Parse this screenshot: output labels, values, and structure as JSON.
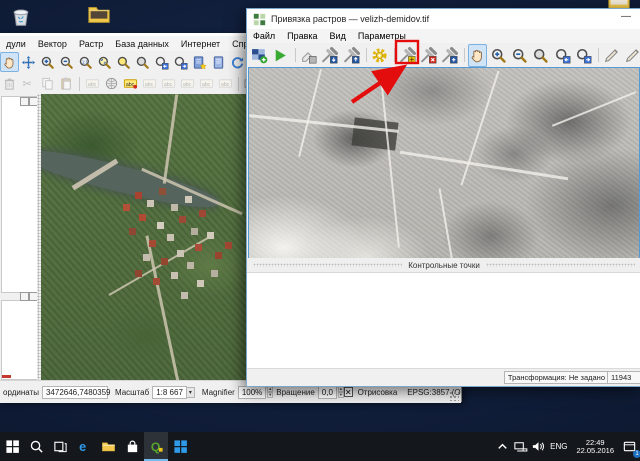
{
  "colors": {
    "annotation_red": "#e40d0d",
    "selection_blue": "#549bd5",
    "desktop_blue": "#0e1a33"
  },
  "desktop": {
    "icons": [
      {
        "id": "recycle-bin"
      },
      {
        "id": "folder-open"
      },
      {
        "id": "folder-top-right"
      }
    ]
  },
  "main_window": {
    "menu": [
      {
        "id": "modules",
        "label": "дули"
      },
      {
        "id": "vector",
        "label": "Вектор"
      },
      {
        "id": "raster",
        "label": "Растр"
      },
      {
        "id": "database",
        "label": "База данных"
      },
      {
        "id": "web",
        "label": "Интернет"
      },
      {
        "id": "help",
        "label": "Справка"
      }
    ],
    "toolbar1": [
      {
        "id": "pan",
        "icon": "hand",
        "pressed": true
      },
      {
        "id": "pan-to-selection",
        "icon": "move"
      },
      {
        "id": "zoom-in",
        "icon": "zoomin"
      },
      {
        "id": "zoom-out",
        "icon": "zoomout"
      },
      {
        "id": "zoom-native",
        "icon": "zoomnative"
      },
      {
        "id": "zoom-full",
        "icon": "zoomfull"
      },
      {
        "id": "zoom-to-selection",
        "icon": "zoomsel"
      },
      {
        "id": "zoom-to-layer",
        "icon": "zoomlayer"
      },
      {
        "id": "zoom-last",
        "icon": "zoomlast"
      },
      {
        "id": "zoom-next",
        "icon": "zoomnext"
      },
      {
        "id": "new-bookmark",
        "icon": "booknew"
      },
      {
        "id": "show-bookmarks",
        "icon": "bookshow"
      },
      {
        "id": "refresh",
        "icon": "refresh"
      }
    ],
    "toolbar2": [
      {
        "id": "delete-selected",
        "icon": "trash",
        "disabled": true
      },
      {
        "id": "cut-features",
        "icon": "cut",
        "disabled": true
      },
      {
        "id": "copy-features",
        "icon": "copy",
        "disabled": true
      },
      {
        "id": "paste-features",
        "icon": "paste",
        "disabled": true
      },
      {
        "sep": true
      },
      {
        "id": "labeling-options",
        "icon": "abc",
        "disabled": true
      },
      {
        "id": "label-pie",
        "icon": "sphere"
      },
      {
        "id": "labeling-active",
        "icon": "abcactive"
      },
      {
        "id": "pin-labels",
        "icon": "abc",
        "disabled": true
      },
      {
        "id": "highlight-labels",
        "icon": "abc",
        "disabled": true
      },
      {
        "id": "move-label",
        "icon": "abc",
        "disabled": true
      },
      {
        "id": "rotate-label",
        "icon": "abc",
        "disabled": true
      },
      {
        "id": "change-label",
        "icon": "abc",
        "disabled": true
      },
      {
        "sep": true
      },
      {
        "id": "csw-search",
        "icon": "csw"
      }
    ],
    "statusbar": {
      "coord_label": "ординаты",
      "coord_value": "3472646,7480359",
      "scale_label": "Масштаб",
      "scale_value": "1:8 667",
      "magnifier_label": "Magnifier",
      "magnifier_value": "100%",
      "rotation_label": "Вращение",
      "rotation_value": "0,0",
      "render_checkbox_glyph": "✕",
      "render_label": "Отрисовка",
      "crs_value": "EPSG:3857 (OTF)"
    }
  },
  "georeferencer": {
    "title": "Привязка растров — velizh-demidov.tif",
    "minimize_glyph": "—",
    "menu": [
      {
        "id": "file",
        "label": "Файл"
      },
      {
        "id": "edit",
        "label": "Правка"
      },
      {
        "id": "view",
        "label": "Вид"
      },
      {
        "id": "settings",
        "label": "Параметры"
      }
    ],
    "toolbar": [
      {
        "id": "open-raster",
        "icon": "checker"
      },
      {
        "id": "start-georeferencing",
        "icon": "play"
      },
      {
        "sep": true
      },
      {
        "id": "gdal-script",
        "icon": "script"
      },
      {
        "id": "load-gcp",
        "icon": "satload"
      },
      {
        "id": "save-gcp",
        "icon": "satsave"
      },
      {
        "sep": true
      },
      {
        "id": "transformation-settings",
        "icon": "gear"
      },
      {
        "sep": true
      },
      {
        "id": "add-point",
        "icon": "satadd",
        "boxed": true
      },
      {
        "id": "delete-point",
        "icon": "satdel"
      },
      {
        "id": "move-point",
        "icon": "satmove"
      },
      {
        "sep": true
      },
      {
        "id": "pan",
        "icon": "hand",
        "pressed": true
      },
      {
        "id": "zoom-in",
        "icon": "zoomin"
      },
      {
        "id": "zoom-out",
        "icon": "zoomout"
      },
      {
        "id": "zoom-to-layer",
        "icon": "zoomlayer"
      },
      {
        "id": "zoom-last",
        "icon": "zoomlast"
      },
      {
        "id": "zoom-next",
        "icon": "zoomnext"
      },
      {
        "sep": true
      },
      {
        "id": "link-georef-to-qgis",
        "icon": "pencil"
      },
      {
        "id": "link-qgis-to-georef",
        "icon": "pencil"
      }
    ],
    "gcp_section_label": "Контрольные точки",
    "status_transform": "Трансформация: Не задано",
    "status_coord_partial": "11943"
  },
  "taskbar": {
    "lang": "ENG",
    "time": "22:49",
    "date": "22.05.2016",
    "notification_badge": "1"
  }
}
